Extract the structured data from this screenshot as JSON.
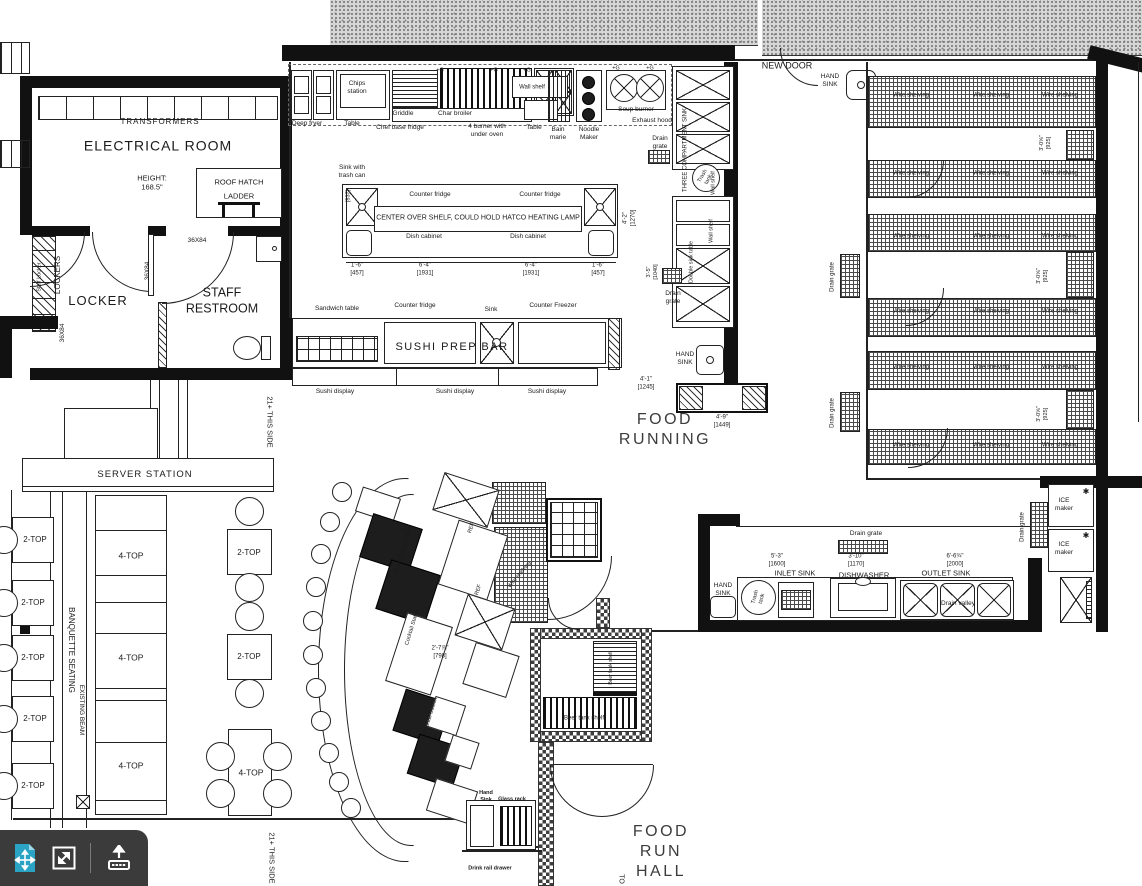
{
  "meta": {
    "colors": {
      "line": "#1a1a1a",
      "big_text": "#3c3c3c",
      "toolbar_bg": "#3b3b3b",
      "accent_teal": "#2aa3c4",
      "stipple": "#d6d6d6"
    }
  },
  "toolbar": {
    "icons": [
      {
        "name": "fit-to-page-icon",
        "color": "#2aa3c4"
      },
      {
        "name": "fullscreen-icon",
        "color": "#ffffff"
      },
      {
        "name": "upload-icon",
        "color": "#ffffff"
      }
    ]
  },
  "labels": [
    {
      "t": "TRANSFORMERS",
      "x": 160,
      "y": 122,
      "fs": 8,
      "ls": 1,
      "n": "transformers-label"
    },
    {
      "t": "ELECTRICAL ROOM",
      "x": 158,
      "y": 146,
      "fs": 14,
      "ls": 1,
      "n": "electrical-room-label"
    },
    {
      "t": "HEIGHT:\n168.5\"",
      "x": 152,
      "y": 183,
      "fs": 7.5
    },
    {
      "t": "ROOF HATCH",
      "x": 239,
      "y": 182,
      "fs": 7.5,
      "n": "roof-hatch-label"
    },
    {
      "t": "LADDER",
      "x": 239,
      "y": 196,
      "fs": 7.5
    },
    {
      "t": "LOCKER",
      "x": 98,
      "y": 301,
      "fs": 13,
      "ls": 1,
      "n": "locker-room-label"
    },
    {
      "t": "STAFF\nRESTROOM",
      "x": 222,
      "y": 301,
      "fs": 12.5,
      "n": "staff-restroom-label"
    },
    {
      "t": "LOCKERS",
      "x": 58,
      "y": 275,
      "fs": 8,
      "rot": -90
    },
    {
      "t": "Staff Locker",
      "x": 40,
      "y": 277,
      "fs": 5.5,
      "rot": -90
    },
    {
      "t": "36X84",
      "x": 148,
      "y": 271,
      "fs": 6.5,
      "rot": -90
    },
    {
      "t": "36X84",
      "x": 197,
      "y": 241,
      "fs": 6.5
    },
    {
      "t": "36X84",
      "x": 63,
      "y": 333,
      "fs": 6.5,
      "rot": -90
    },
    {
      "t": "SERVER STATION",
      "x": 145,
      "y": 475,
      "fs": 9.5,
      "ls": 1,
      "n": "server-station-label"
    },
    {
      "t": "BANQUETTE SEATING",
      "x": 71,
      "y": 650,
      "fs": 8,
      "rot": 90,
      "n": "banquette-seating-label"
    },
    {
      "t": "EXISTING BEAM",
      "x": 81,
      "y": 710,
      "fs": 6.5,
      "rot": 90
    },
    {
      "t": "21+ THIS SIDE",
      "x": 270,
      "y": 422,
      "fs": 7.5,
      "rot": 90
    },
    {
      "t": "21+ THIS SIDE",
      "x": 272,
      "y": 858,
      "fs": 7.5,
      "rot": 90
    },
    {
      "t": "NEW DOOR",
      "x": 787,
      "y": 66,
      "fs": 9,
      "n": "new-door-label"
    },
    {
      "t": "FOOD\nRUNNING",
      "x": 665,
      "y": 430,
      "fs": 16,
      "ls": 2.5,
      "c": "#3c3c3c",
      "n": "food-running-label"
    },
    {
      "t": "FOOD\nRUN\nHALL",
      "x": 661,
      "y": 852,
      "fs": 16,
      "ls": 2.5,
      "c": "#3c3c3c",
      "n": "food-run-hall-label"
    },
    {
      "t": "TO",
      "x": 620,
      "y": 879,
      "fs": 7,
      "rot": 90
    },
    {
      "t": "SUSHI PREP BAR",
      "x": 452,
      "y": 348,
      "fs": 11,
      "ls": 1.5,
      "n": "sushi-prep-bar-label"
    },
    {
      "t": "Chips\nstation",
      "x": 357,
      "y": 88,
      "fs": 6.5
    },
    {
      "t": "Deep fryer",
      "x": 307,
      "y": 124,
      "fs": 6.5
    },
    {
      "t": "Table",
      "x": 352,
      "y": 124,
      "fs": 6.5
    },
    {
      "t": "Griddle",
      "x": 403,
      "y": 114,
      "fs": 6.5
    },
    {
      "t": "Char broiler",
      "x": 455,
      "y": 114,
      "fs": 6.5
    },
    {
      "t": "Chef base fridge",
      "x": 400,
      "y": 128,
      "fs": 6.5
    },
    {
      "t": "4 burner with\nunder oven",
      "x": 487,
      "y": 131,
      "fs": 6.5
    },
    {
      "t": "Wall shelf",
      "x": 532,
      "y": 88,
      "fs": 6
    },
    {
      "t": "Table",
      "x": 534,
      "y": 128,
      "fs": 6.5
    },
    {
      "t": "Bain\nmarie",
      "x": 558,
      "y": 134,
      "fs": 6.5
    },
    {
      "t": "Noodle\nMaker",
      "x": 589,
      "y": 134,
      "fs": 6.5
    },
    {
      "t": "Soup burner",
      "x": 636,
      "y": 110,
      "fs": 6.5
    },
    {
      "t": "Exhaust hood",
      "x": 652,
      "y": 121,
      "fs": 6.5
    },
    {
      "t": "Drain\ngrate",
      "x": 660,
      "y": 143,
      "fs": 6.5
    },
    {
      "t": "+G",
      "x": 440,
      "y": 71,
      "fs": 5.5
    },
    {
      "t": "+G",
      "x": 494,
      "y": 71,
      "fs": 5.5
    },
    {
      "t": "+G",
      "x": 527,
      "y": 71,
      "fs": 5.5
    },
    {
      "t": "+G",
      "x": 616,
      "y": 69,
      "fs": 5.5
    },
    {
      "t": "+G",
      "x": 650,
      "y": 69,
      "fs": 5.5
    },
    {
      "t": "Sink with\ntrash can",
      "x": 352,
      "y": 172,
      "fs": 6.5
    },
    {
      "t": "Counter fridge",
      "x": 430,
      "y": 195,
      "fs": 6.5
    },
    {
      "t": "Counter fridge",
      "x": 540,
      "y": 195,
      "fs": 6.5
    },
    {
      "t": "CENTER OVER SHELF, COULD HOLD HATCO HEATING LAMP",
      "x": 478,
      "y": 219,
      "fs": 7
    },
    {
      "t": "Dish cabinet",
      "x": 424,
      "y": 237,
      "fs": 6.5
    },
    {
      "t": "Dish cabinet",
      "x": 528,
      "y": 237,
      "fs": 6.5
    },
    {
      "t": "1'-6\"\n[457]",
      "x": 357,
      "y": 270,
      "fs": 6
    },
    {
      "t": "6'-4\"\n[1931]",
      "x": 425,
      "y": 270,
      "fs": 6
    },
    {
      "t": "6'-4\"\n[1931]",
      "x": 531,
      "y": 270,
      "fs": 6
    },
    {
      "t": "1'-6\"\n[457]",
      "x": 598,
      "y": 270,
      "fs": 6
    },
    {
      "t": "4'-2\"\n[1270]",
      "x": 630,
      "y": 218,
      "fs": 6,
      "rot": -90
    },
    {
      "t": "[837]",
      "x": 349,
      "y": 196,
      "fs": 5.5,
      "rot": -90
    },
    {
      "t": "3'-5\"\n[1040]",
      "x": 653,
      "y": 272,
      "fs": 5.5,
      "rot": -90
    },
    {
      "t": "Sandwich table",
      "x": 337,
      "y": 309,
      "fs": 6.5
    },
    {
      "t": "Counter fridge",
      "x": 415,
      "y": 306,
      "fs": 6.5
    },
    {
      "t": "Sink",
      "x": 491,
      "y": 310,
      "fs": 6.5
    },
    {
      "t": "Counter Freezer",
      "x": 553,
      "y": 306,
      "fs": 6.5
    },
    {
      "t": "Sushi display",
      "x": 335,
      "y": 392,
      "fs": 6.5
    },
    {
      "t": "Sushi display",
      "x": 455,
      "y": 392,
      "fs": 6.5
    },
    {
      "t": "Sushi display",
      "x": 547,
      "y": 392,
      "fs": 6.5
    },
    {
      "t": "THREE COMPARTMENT SINK",
      "x": 686,
      "y": 150,
      "fs": 6,
      "rot": -90
    },
    {
      "t": "Wall shelf",
      "x": 714,
      "y": 183,
      "fs": 5.5,
      "rot": -90
    },
    {
      "t": "Trash\ntank",
      "x": 706,
      "y": 178,
      "fs": 5.5,
      "rot": -60
    },
    {
      "t": "Wall shelf",
      "x": 712,
      "y": 231,
      "fs": 5.5,
      "rot": -90
    },
    {
      "t": "Double sink table",
      "x": 692,
      "y": 262,
      "fs": 5.5,
      "rot": -90
    },
    {
      "t": "Drain\ngrate",
      "x": 673,
      "y": 298,
      "fs": 6.5
    },
    {
      "t": "HAND\nSINK",
      "x": 685,
      "y": 359,
      "fs": 6.5
    },
    {
      "t": "4'-1\"\n[1245]",
      "x": 646,
      "y": 384,
      "fs": 6
    },
    {
      "t": "4'-9\"\n[1449]",
      "x": 722,
      "y": 422,
      "fs": 6
    },
    {
      "t": "HAND\nSINK",
      "x": 830,
      "y": 81,
      "fs": 6.5
    },
    {
      "t": "Wire shelving",
      "x": 911,
      "y": 96,
      "fs": 6
    },
    {
      "t": "Wire shelving",
      "x": 991,
      "y": 96,
      "fs": 6
    },
    {
      "t": "Wire shelving",
      "x": 1060,
      "y": 96,
      "fs": 6
    },
    {
      "t": "Wire shelving",
      "x": 911,
      "y": 174,
      "fs": 6
    },
    {
      "t": "Wire shelving",
      "x": 991,
      "y": 174,
      "fs": 6
    },
    {
      "t": "Wire shelving",
      "x": 1060,
      "y": 174,
      "fs": 6
    },
    {
      "t": "Wire shelving",
      "x": 911,
      "y": 237,
      "fs": 6
    },
    {
      "t": "Wire shelving",
      "x": 991,
      "y": 237,
      "fs": 6
    },
    {
      "t": "Wire shelving",
      "x": 1060,
      "y": 237,
      "fs": 6
    },
    {
      "t": "Wire shelving",
      "x": 911,
      "y": 312,
      "fs": 6
    },
    {
      "t": "Wire shelving",
      "x": 991,
      "y": 312,
      "fs": 6
    },
    {
      "t": "Wire shelving",
      "x": 1060,
      "y": 312,
      "fs": 6
    },
    {
      "t": "Wire shelving",
      "x": 911,
      "y": 368,
      "fs": 6
    },
    {
      "t": "Wire shelving",
      "x": 991,
      "y": 368,
      "fs": 6
    },
    {
      "t": "Wire shelving",
      "x": 1060,
      "y": 368,
      "fs": 6
    },
    {
      "t": "Wire shelving",
      "x": 911,
      "y": 446,
      "fs": 6
    },
    {
      "t": "Wire shelving",
      "x": 991,
      "y": 446,
      "fs": 6
    },
    {
      "t": "Wire shelving",
      "x": 1060,
      "y": 446,
      "fs": 6
    },
    {
      "t": "3'-0⅝\"\n[925]",
      "x": 1046,
      "y": 143,
      "fs": 5.5,
      "rot": -90
    },
    {
      "t": "3'-0⅝\"\n[925]",
      "x": 1043,
      "y": 276,
      "fs": 5.5,
      "rot": -90
    },
    {
      "t": "3'-0⅝\"\n[925]",
      "x": 1043,
      "y": 414,
      "fs": 5.5,
      "rot": -90
    },
    {
      "t": "Drain grate",
      "x": 833,
      "y": 277,
      "fs": 6,
      "rot": -90
    },
    {
      "t": "Drain grate",
      "x": 833,
      "y": 413,
      "fs": 6,
      "rot": -90
    },
    {
      "t": "Drain grate",
      "x": 1023,
      "y": 527,
      "fs": 6,
      "rot": -90
    },
    {
      "t": "ICE\nmaker",
      "x": 1064,
      "y": 505,
      "fs": 6.5
    },
    {
      "t": "ICE\nmaker",
      "x": 1064,
      "y": 549,
      "fs": 6.5
    },
    {
      "t": "✱",
      "x": 1086,
      "y": 492,
      "fs": 8
    },
    {
      "t": "✱",
      "x": 1086,
      "y": 536,
      "fs": 8
    },
    {
      "t": "Drain grate",
      "x": 866,
      "y": 534,
      "fs": 6.5
    },
    {
      "t": "5'-3\"\n[1600]",
      "x": 777,
      "y": 561,
      "fs": 6
    },
    {
      "t": "3'-10\"\n[1170]",
      "x": 856,
      "y": 561,
      "fs": 6
    },
    {
      "t": "6'-6¾\"\n[2000]",
      "x": 955,
      "y": 561,
      "fs": 6
    },
    {
      "t": "INLET SINK",
      "x": 795,
      "y": 573,
      "fs": 7.5,
      "n": "inlet-sink-label"
    },
    {
      "t": "DISHWASHER",
      "x": 864,
      "y": 575,
      "fs": 7.5,
      "n": "dishwasher-label"
    },
    {
      "t": "OUTLET SINK",
      "x": 946,
      "y": 573,
      "fs": 7.5,
      "n": "outlet-sink-label"
    },
    {
      "t": "HAND\nSINK",
      "x": 723,
      "y": 590,
      "fs": 6.5
    },
    {
      "t": "Trash\ntank",
      "x": 759,
      "y": 598,
      "fs": 5.5,
      "rot": -75
    },
    {
      "t": "Drain valley",
      "x": 958,
      "y": 604,
      "fs": 6.5
    },
    {
      "t": "Sushi display fridge",
      "x": 404,
      "y": 550,
      "fs": 5.5,
      "rot": -73
    },
    {
      "t": "Cocktail Station",
      "x": 413,
      "y": 627,
      "fs": 5.5,
      "rot": -73
    },
    {
      "t": "Cocktail Station",
      "x": 431,
      "y": 716,
      "fs": 5.5,
      "rot": -73
    },
    {
      "t": "REF",
      "x": 472,
      "y": 528,
      "fs": 5.5,
      "rot": -73
    },
    {
      "t": "REF",
      "x": 479,
      "y": 590,
      "fs": 5.5,
      "rot": -73
    },
    {
      "t": "2'-7⅞\"\n[798]",
      "x": 440,
      "y": 653,
      "fs": 6
    },
    {
      "t": "Hand\nSink",
      "x": 486,
      "y": 797,
      "fs": 5.5,
      "b": true
    },
    {
      "t": "Glass rack",
      "x": 512,
      "y": 800,
      "fs": 5.5,
      "b": true
    },
    {
      "t": "Drink rail drawer",
      "x": 490,
      "y": 869,
      "fs": 5.5,
      "b": true
    },
    {
      "t": "Beer tank shelf",
      "x": 611,
      "y": 668,
      "fs": 5,
      "rot": -90
    },
    {
      "t": "Beer tank shelf",
      "x": 584,
      "y": 719,
      "fs": 6
    },
    {
      "t": "Wire shelving",
      "x": 520,
      "y": 575,
      "fs": 5.5,
      "rot": -50
    },
    {
      "t": "2-TOP",
      "x": 35,
      "y": 540,
      "fs": 8
    },
    {
      "t": "2-TOP",
      "x": 33,
      "y": 603,
      "fs": 8
    },
    {
      "t": "2-TOP",
      "x": 33,
      "y": 658,
      "fs": 8
    },
    {
      "t": "2-TOP",
      "x": 35,
      "y": 719,
      "fs": 8
    },
    {
      "t": "2-TOP",
      "x": 33,
      "y": 786,
      "fs": 8
    },
    {
      "t": "4-TOP",
      "x": 131,
      "y": 556,
      "fs": 8.5
    },
    {
      "t": "4-TOP",
      "x": 131,
      "y": 658,
      "fs": 8.5
    },
    {
      "t": "4-TOP",
      "x": 131,
      "y": 766,
      "fs": 8.5
    },
    {
      "t": "2-TOP",
      "x": 249,
      "y": 553,
      "fs": 8
    },
    {
      "t": "2-TOP",
      "x": 249,
      "y": 657,
      "fs": 8
    },
    {
      "t": "4-TOP",
      "x": 251,
      "y": 773,
      "fs": 8.5
    }
  ]
}
